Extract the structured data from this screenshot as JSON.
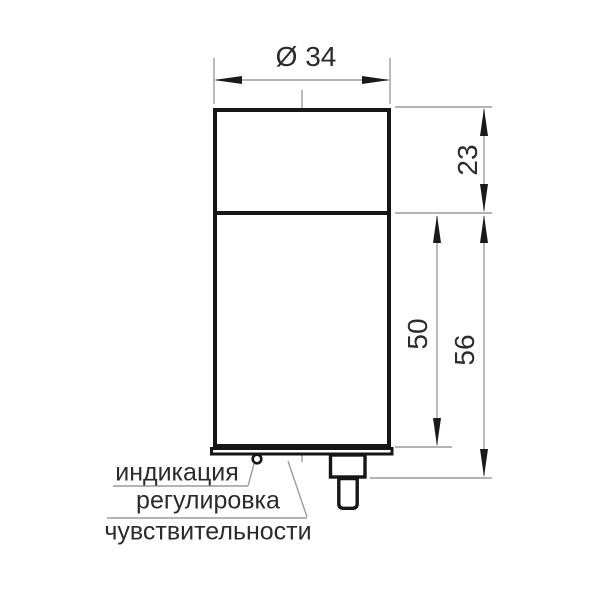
{
  "dimensions": {
    "diameter": "Ø 34",
    "head_height": "23",
    "body_length": "50",
    "total_length": "56"
  },
  "callouts": {
    "indication": "индикация",
    "adjustment_line1": "регулировка",
    "adjustment_line2": "чувствительности"
  },
  "colors": {
    "outline": "#161616",
    "thin_line": "#9c9c9c",
    "arrow": "#1a1a1a",
    "text": "#2b2b2b",
    "background": "#ffffff"
  }
}
